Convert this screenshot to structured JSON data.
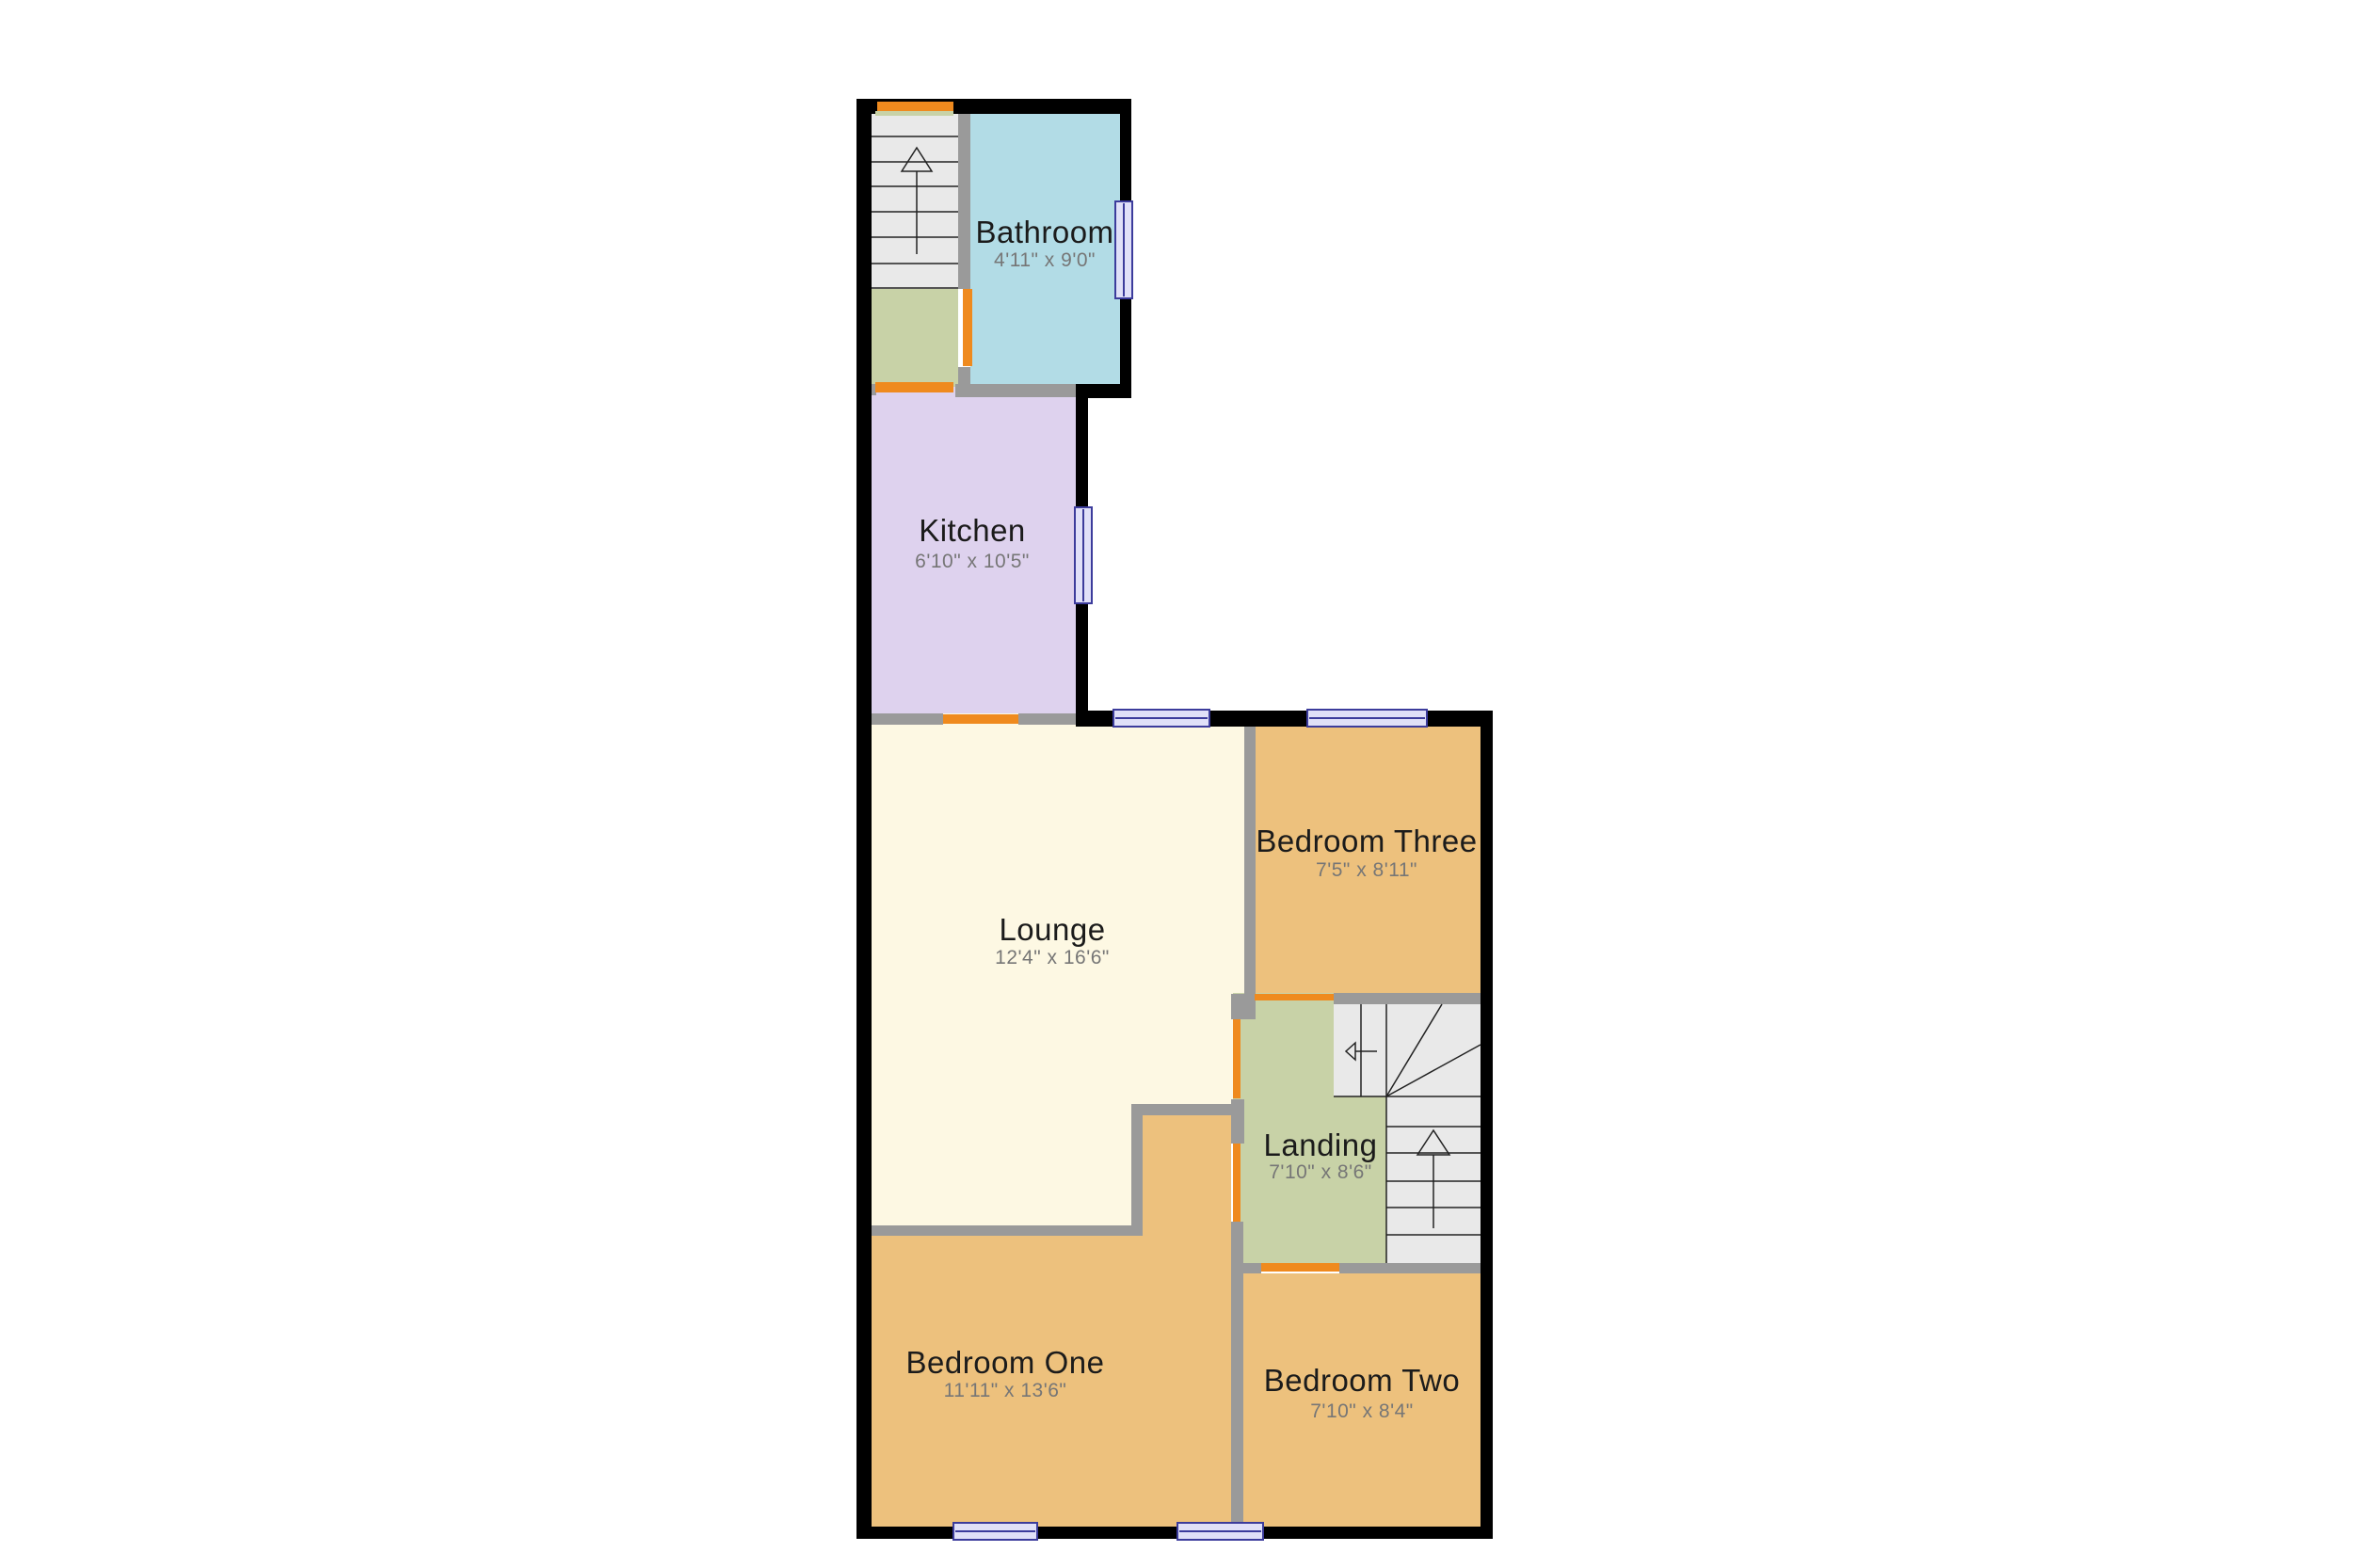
{
  "plan": {
    "rooms": [
      {
        "name": "Bathroom",
        "dims": "4'11\" x 9'0\""
      },
      {
        "name": "Kitchen",
        "dims": "6'10\" x 10'5\""
      },
      {
        "name": "Lounge",
        "dims": "12'4\" x 16'6\""
      },
      {
        "name": "Bedroom Three",
        "dims": "7'5\" x 8'11\""
      },
      {
        "name": "Landing",
        "dims": "7'10\" x 8'6\""
      },
      {
        "name": "Bedroom One",
        "dims": "11'11\" x 13'6\""
      },
      {
        "name": "Bedroom Two",
        "dims": "7'10\" x 8'4\""
      }
    ],
    "colors": {
      "bathroom": "#b2dce6",
      "kitchen": "#ded2ee",
      "lounge": "#fdf8e3",
      "bedroom": "#edc17d",
      "landing": "#c8d2a7",
      "stairs": "#e9e9e9",
      "door": "#ef8a1e",
      "wall_exterior": "#000000",
      "wall_interior": "#9a9a9a",
      "window_fill": "#e0e0f8",
      "window_border": "#3c3c9c",
      "label_text": "#1b1b1b",
      "dims_text": "#767676",
      "background": "#ffffff"
    }
  }
}
